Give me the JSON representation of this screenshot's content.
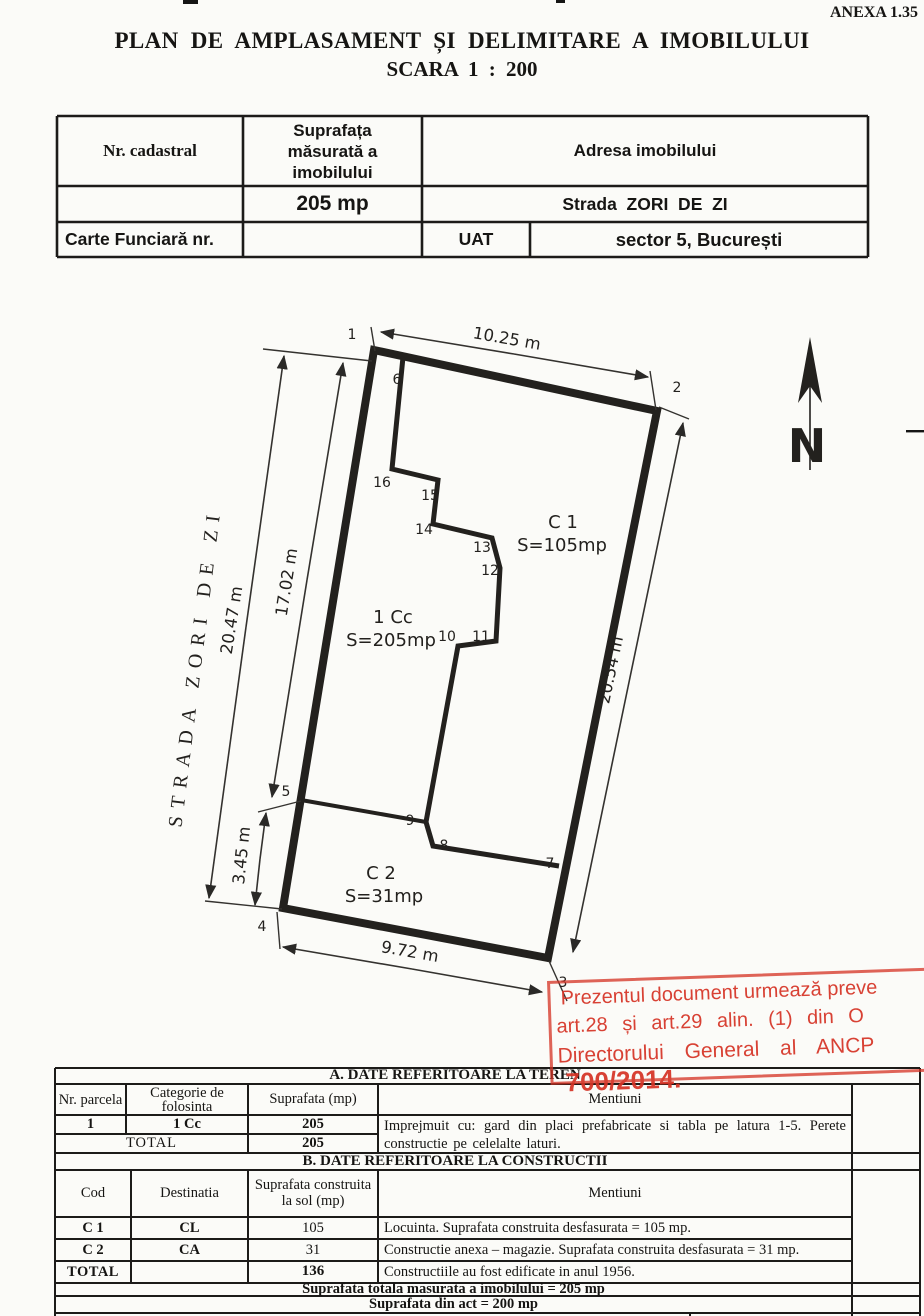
{
  "page": {
    "anexa": "ANEXA 1.35",
    "title": "PLAN DE AMPLASAMENT ȘI DELIMITARE A IMOBILULUI",
    "subtitle": "SCARA 1 : 200"
  },
  "colors": {
    "ink": "#1d1c1a",
    "stamp_red": "#d63426",
    "paper": "#fbfbf8"
  },
  "info_table": {
    "nr_cadastral_label": "Nr. cadastral",
    "suprafata_label": "Suprafața măsurată a imobilului",
    "adresa_label": "Adresa imobilului",
    "suprafata_value": "205 mp",
    "adresa_value": "Strada  ZORI  DE  ZI",
    "carte_funciara_label": "Carte Funciară nr.",
    "uat_label": "UAT",
    "uat_value": "sector 5, București"
  },
  "plan": {
    "north_label": "N",
    "street_label": "STRADA  ZORI  DE  ZI",
    "points": [
      {
        "n": "1"
      },
      {
        "n": "2"
      },
      {
        "n": "3"
      },
      {
        "n": "4"
      },
      {
        "n": "5"
      },
      {
        "n": "6"
      },
      {
        "n": "7"
      },
      {
        "n": "8"
      },
      {
        "n": "9"
      },
      {
        "n": "10"
      },
      {
        "n": "11"
      },
      {
        "n": "12"
      },
      {
        "n": "13"
      },
      {
        "n": "14"
      },
      {
        "n": "15"
      },
      {
        "n": "16"
      }
    ],
    "dimensions": [
      {
        "text": "10.25 m"
      },
      {
        "text": "20.47 m"
      },
      {
        "text": "17.02 m"
      },
      {
        "text": "3.45 m"
      },
      {
        "text": "20.54 m"
      },
      {
        "text": "9.72 m"
      }
    ],
    "areas": [
      {
        "code": "C 1",
        "area": "S=105mp"
      },
      {
        "code": "1 Cc",
        "area": "S=205mp"
      },
      {
        "code": "C 2",
        "area": "S=31mp"
      }
    ]
  },
  "stamp": {
    "line1": "Prezentul document urmează preve",
    "line2": "art.28 și art.29 alin. (1) din O",
    "line3": "Directorului General al ANCP",
    "line4": "700/2014."
  },
  "teren_table": {
    "title": "A. DATE  REFERITOARE  LA  TEREN",
    "headers": [
      "Nr. parcela",
      "Categorie de folosinta",
      "Suprafata (mp)",
      "Mentiuni"
    ],
    "row": {
      "nr": "1",
      "categorie": "1 Cc",
      "suprafata": "205"
    },
    "mentiuni": "Imprejmuit cu: gard din placi prefabricate si tabla pe latura 1-5. Perete constructie pe celelalte laturi.",
    "total_label": "TOTAL",
    "total_value": "205"
  },
  "constructii_table": {
    "title": "B. DATE  REFERITOARE  LA  CONSTRUCTII",
    "headers": [
      "Cod",
      "Destinatia",
      "Suprafata construita la sol (mp)",
      "Mentiuni"
    ],
    "rows": [
      {
        "cod": "C 1",
        "dest": "CL",
        "supr": "105",
        "ment": "Locuinta. Suprafata construita desfasurata = 105 mp."
      },
      {
        "cod": "C 2",
        "dest": "CA",
        "supr": "31",
        "ment": "Constructie anexa – magazie. Suprafata construita desfasurata = 31 mp."
      }
    ],
    "total_label": "TOTAL",
    "total_value": "136",
    "total_mentiuni": "Constructiile au fost edificate in anul 1956."
  },
  "summary": {
    "line1": "Suprafata totala masurata a imobilului = 205 mp",
    "line2": "Suprafata din act = 200 mp"
  }
}
